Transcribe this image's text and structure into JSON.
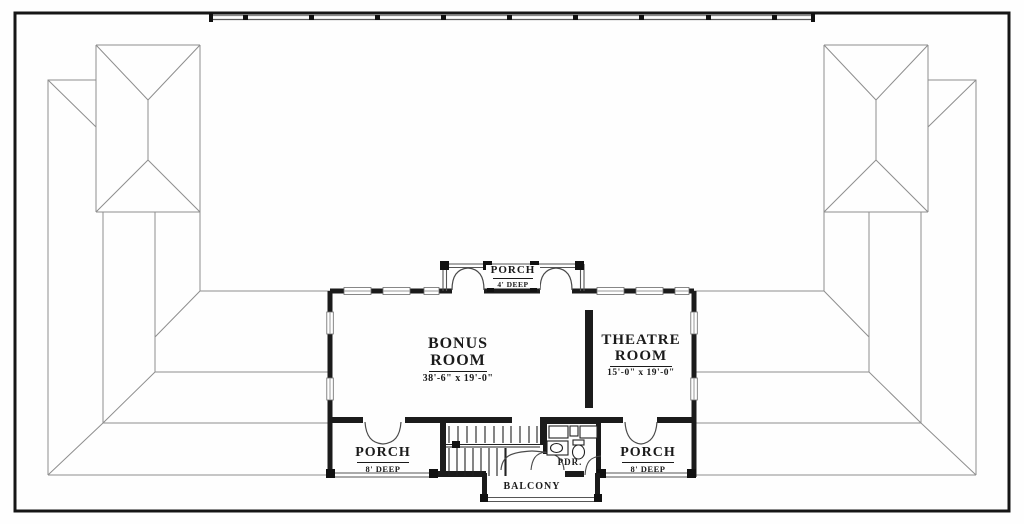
{
  "rooms": {
    "bonus": {
      "line1": "BONUS",
      "line2": "ROOM",
      "dims": "38'-6\" x 19'-0\""
    },
    "theatre": {
      "line1": "THEATRE",
      "line2": "ROOM",
      "dims": "15'-0\" x 19'-0\""
    }
  },
  "porches": {
    "top": {
      "name": "PORCH",
      "depth": "4' DEEP"
    },
    "left": {
      "name": "PORCH",
      "depth": "8' DEEP"
    },
    "right": {
      "name": "PORCH",
      "depth": "8' DEEP"
    }
  },
  "balcony": {
    "name": "BALCONY"
  },
  "powder_room": {
    "name": "PDR."
  },
  "colors": {
    "wall": "#1b1b1b",
    "roof_line": "#8e8e8e",
    "border": "#161616",
    "background": "#fefefe"
  }
}
